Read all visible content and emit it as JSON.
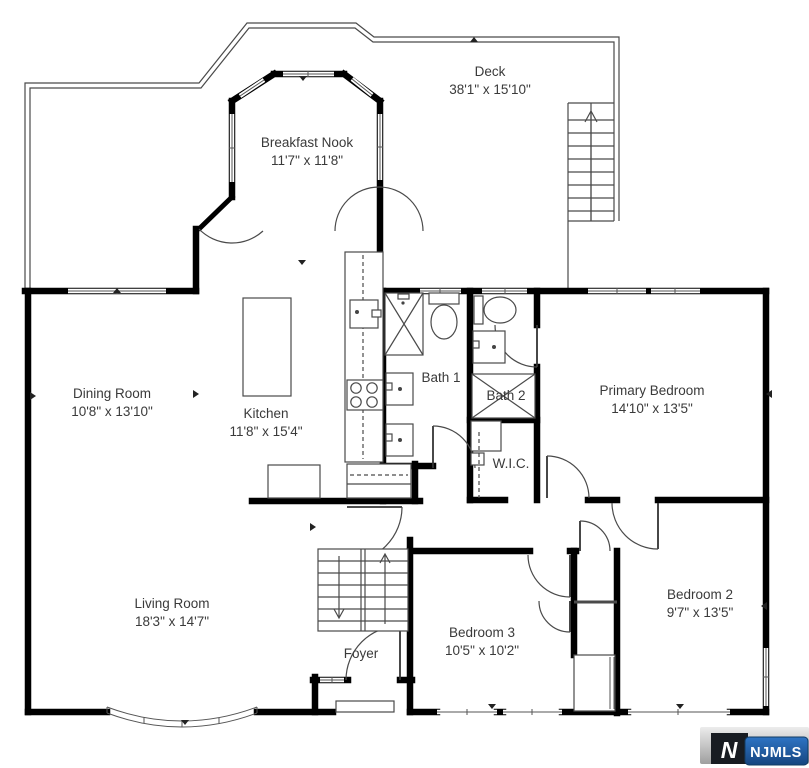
{
  "colors": {
    "wall": "#000000",
    "drawing_line": "#4a4a4a",
    "label_text": "#3a3a3a",
    "logo_blue": "#1f5fa7",
    "logo_dark": "#181c22",
    "logo_gray": "#c9c9c9"
  },
  "rooms": {
    "deck": {
      "name": "Deck",
      "dims": "38'1\" x 15'10\""
    },
    "breakfast_nook": {
      "name": "Breakfast Nook",
      "dims": "11'7\" x 11'8\""
    },
    "dining_room": {
      "name": "Dining Room",
      "dims": "10'8\" x 13'10\""
    },
    "kitchen": {
      "name": "Kitchen",
      "dims": "11'8\" x 15'4\""
    },
    "bath1": {
      "name": "Bath 1"
    },
    "bath2": {
      "name": "Bath 2"
    },
    "primary_bedroom": {
      "name": "Primary Bedroom",
      "dims": "14'10\" x 13'5\""
    },
    "wic": {
      "name": "W.I.C."
    },
    "living_room": {
      "name": "Living Room",
      "dims": "18'3\" x 14'7\""
    },
    "foyer": {
      "name": "Foyer"
    },
    "bedroom3": {
      "name": "Bedroom 3",
      "dims": "10'5\" x 10'2\""
    },
    "bedroom2": {
      "name": "Bedroom 2",
      "dims": "9'7\" x 13'5\""
    }
  },
  "watermark": {
    "monogram": "N",
    "label": "NJMLS"
  }
}
